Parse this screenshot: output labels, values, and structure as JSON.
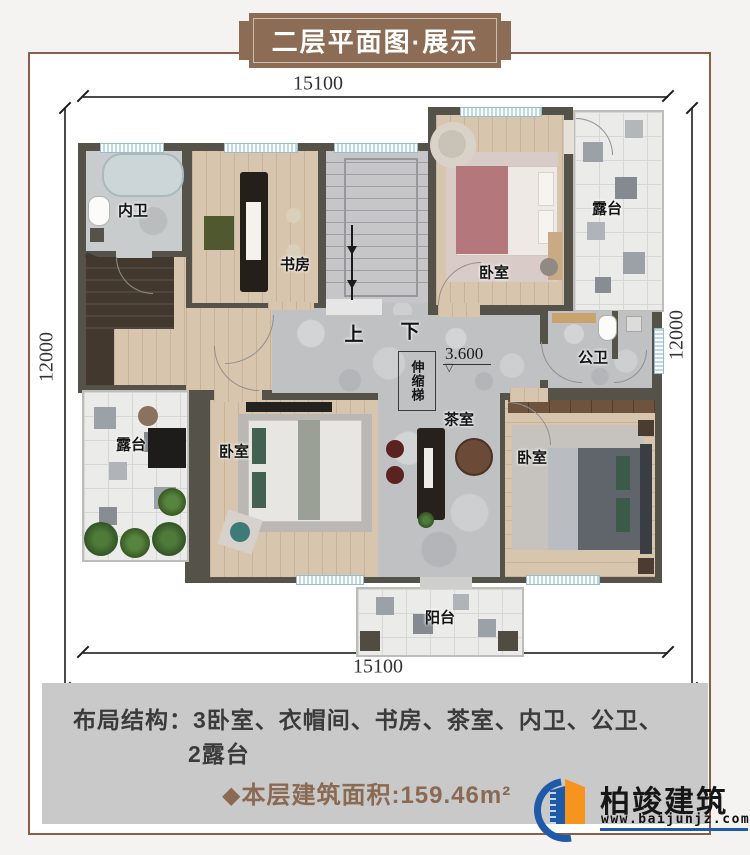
{
  "banner": {
    "title": "二层平面图·展示"
  },
  "dimensions": {
    "top": "15100",
    "bottom": "15100",
    "left": "12000",
    "right": "12000"
  },
  "plan": {
    "labels": {
      "inner_bath": "内卫",
      "study": "书房",
      "bedroom_top_right": "卧室",
      "terrace_right": "露台",
      "public_bath": "公卫",
      "retractable_ladder": "伸缩梯",
      "tea_room": "茶室",
      "terrace_left": "露台",
      "bedroom_bottom_left": "卧室",
      "bedroom_bottom_right": "卧室",
      "balcony": "阳台",
      "stairs_up": "上",
      "stairs_down": "下",
      "elevation": "3.600",
      "elevation_mark": "▽"
    }
  },
  "footer": {
    "layout_label": "布局结构：",
    "layout_line1": "3卧室、衣帽间、书房、茶室、内卫、公卫、",
    "layout_line2": "2露台",
    "area_text": "◆本层建筑面积:159.46m²"
  },
  "logo": {
    "name": "柏竣建筑",
    "website": "www.baijunjz.com"
  },
  "colors": {
    "banner_brown": "#8d6c55",
    "area_brown": "#8a6a52",
    "wall": "#55524a",
    "logo_blue": "#1e5aa8",
    "logo_orange": "#f7941d",
    "window_blue": "#bcd9e4"
  }
}
